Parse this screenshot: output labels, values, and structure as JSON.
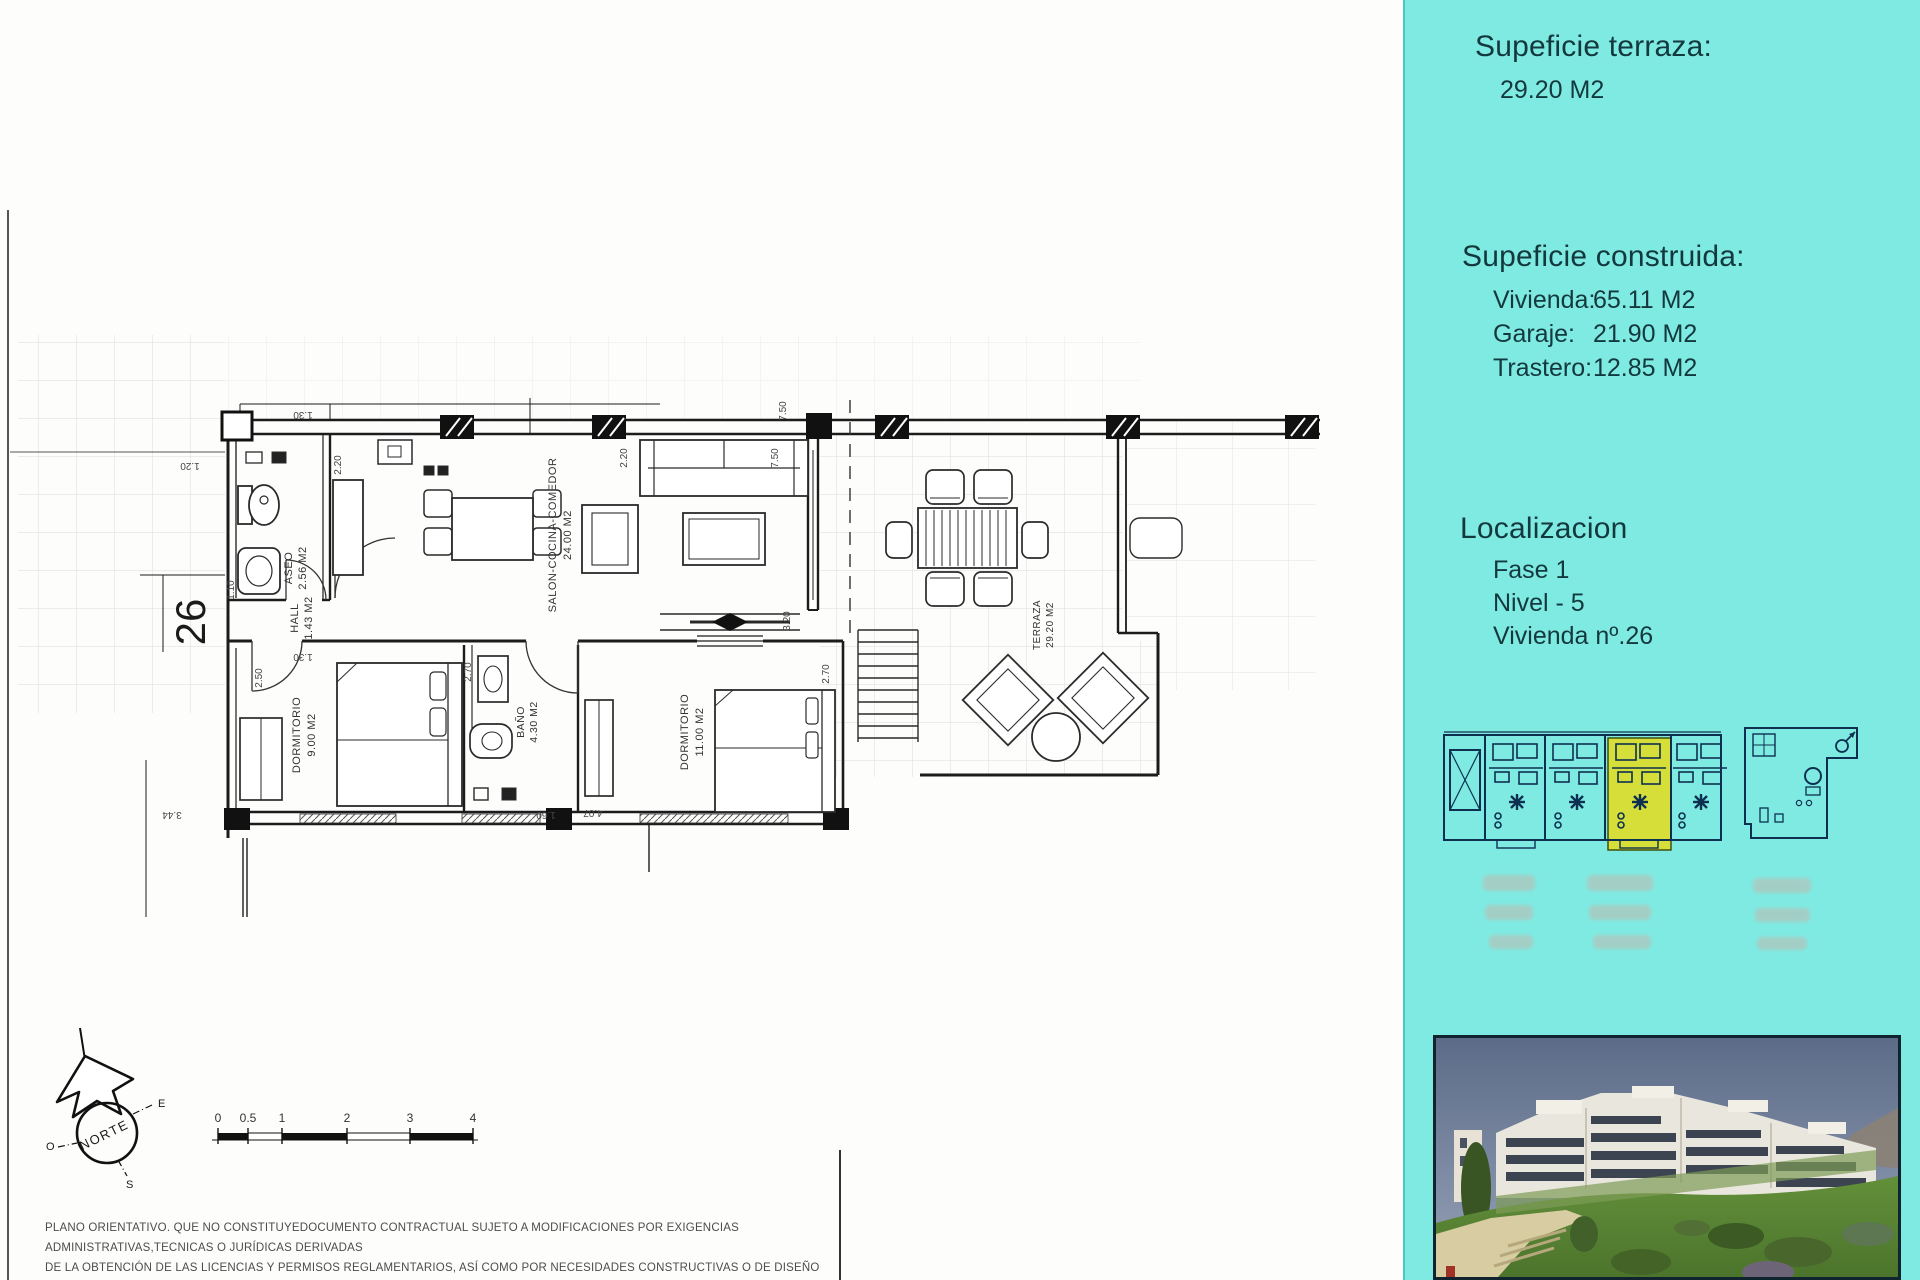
{
  "sidebar": {
    "background_color": "#7feae2",
    "text_color": "#13383e",
    "terrace": {
      "title": "Supeficie terraza:",
      "value": "29.20 M2"
    },
    "built": {
      "title": "Supeficie construida:",
      "items": [
        {
          "label": "Vivienda:",
          "value": "65.11 M2"
        },
        {
          "label": "Garaje:",
          "value": "21.90 M2"
        },
        {
          "label": "Trastero:",
          "value": "12.85 M2"
        }
      ]
    },
    "location": {
      "title": "Localizacion",
      "items": [
        "Fase 1",
        "Nivel - 5",
        "Vivienda nº.26"
      ]
    },
    "highlight_color": "#d6df3a"
  },
  "plan": {
    "unit_number": "26",
    "rooms": [
      {
        "name": "SALON-COCINA-COMEDOR",
        "area": "24.00 M2"
      },
      {
        "name": "ASEO",
        "area": "2.56 M2"
      },
      {
        "name": "HALL",
        "area": "1.43 M2"
      },
      {
        "name": "DORMITORIO",
        "area": "9.00 M2"
      },
      {
        "name": "BAÑO",
        "area": "4.30 M2"
      },
      {
        "name": "DORMITORIO",
        "area": "11.00 M2"
      },
      {
        "name": "TERRAZA",
        "area": "29.20 M2"
      }
    ],
    "dims": [
      "1.20",
      "1.30",
      "1.30",
      "2.20",
      "2.20",
      "7.50",
      "7.50",
      "3.20",
      "2.50",
      "1.10",
      "3.44",
      "1.60",
      "4.07",
      "2.70",
      "2.70"
    ],
    "compass": {
      "label": "NORTE",
      "e": "E",
      "o": "O",
      "s": "S"
    },
    "scale": {
      "labels": [
        "0",
        "0.5",
        "1",
        "2",
        "3",
        "4"
      ]
    }
  },
  "disclaimer": {
    "line1": "PLANO ORIENTATIVO. QUE NO CONSTITUYEDOCUMENTO CONTRACTUAL SUJETO A MODIFICACIONES POR EXIGENCIAS ADMINISTRATIVAS,TECNICAS O JURÍDICAS DERIVADAS",
    "line2": "DE LA OBTENCIÓN DE LAS LICENCIAS Y PERMISOS REGLAMENTARIOS, ASÍ COMO POR NECESIDADES CONSTRUCTIVAS  O DE DISEÑO DERIVADAS DE LA DIRECCIÓN DE LA OBRA",
    "line3": "LAS SUPERFICIES TIENEN CARÁCTER PROVISIONAL HASTA LA OBTENCIÓN DE LA LICENCIA DE PRIMERA OCUPACIÓN , EL AMUEBLAMIENTO,JARDINERIA Y MOBILIARIO URBANO"
  }
}
